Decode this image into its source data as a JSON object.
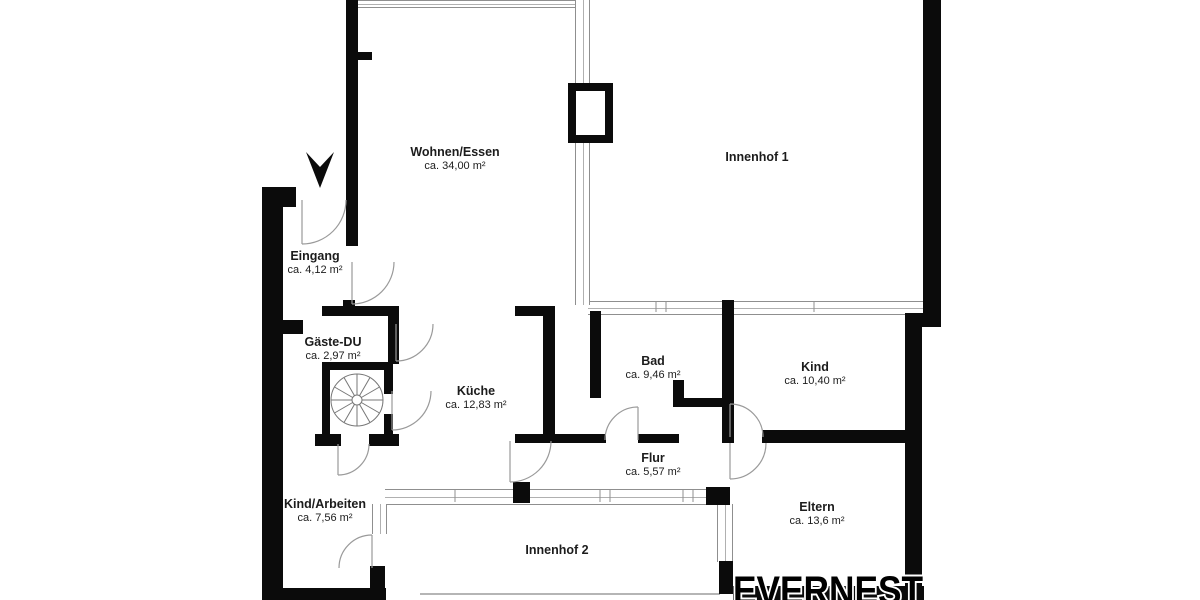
{
  "floorplan": {
    "watermark": "EVERNEST",
    "colors": {
      "background": "#ffffff",
      "wall": "#0b0b0b",
      "thin_line": "#8f8f8f",
      "text": "#1c1c1c",
      "watermark_fill": "#000000",
      "watermark_outline": "#ffffff"
    },
    "icons": {
      "entrance_arrow": "solid black downward arrow marking the entrance",
      "spiral_staircase": "circular stair symbol with radial treads"
    },
    "rooms": [
      {
        "id": "wohnen-essen",
        "name": "Wohnen/Essen",
        "area": "ca. 34,00 m²"
      },
      {
        "id": "innenhof-1",
        "name": "Innenhof 1",
        "area": ""
      },
      {
        "id": "eingang",
        "name": "Eingang",
        "area": "ca. 4,12 m²"
      },
      {
        "id": "gaeste-du",
        "name": "Gäste-DU",
        "area": "ca. 2,97 m²"
      },
      {
        "id": "kueche",
        "name": "Küche",
        "area": "ca. 12,83 m²"
      },
      {
        "id": "bad",
        "name": "Bad",
        "area": "ca. 9,46 m²"
      },
      {
        "id": "kind",
        "name": "Kind",
        "area": "ca. 10,40 m²"
      },
      {
        "id": "flur",
        "name": "Flur",
        "area": "ca. 5,57 m²"
      },
      {
        "id": "kind-arbeiten",
        "name": "Kind/Arbeiten",
        "area": "ca. 7,56 m²"
      },
      {
        "id": "eltern",
        "name": "Eltern",
        "area": "ca. 13,6 m²"
      },
      {
        "id": "innenhof-2",
        "name": "Innenhof 2",
        "area": ""
      }
    ]
  }
}
